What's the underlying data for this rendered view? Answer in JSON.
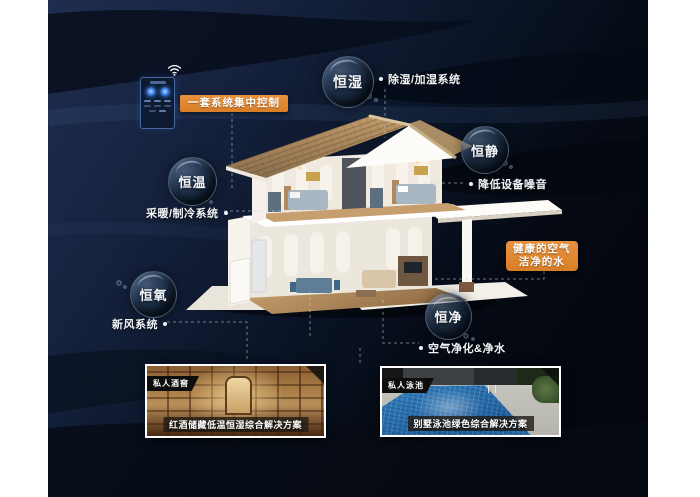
{
  "bubbles": [
    {
      "id": "heng-shi",
      "label": "恒湿"
    },
    {
      "id": "heng-jing",
      "label": "恒静"
    },
    {
      "id": "heng-wen",
      "label": "恒温"
    },
    {
      "id": "heng-yang",
      "label": "恒氧"
    },
    {
      "id": "heng-jing2",
      "label": "恒净"
    }
  ],
  "callouts": [
    {
      "id": "dehumidify",
      "label": "除湿/加湿系统"
    },
    {
      "id": "noise",
      "label": "降低设备噪音"
    },
    {
      "id": "heating",
      "label": "采暖/制冷系统"
    },
    {
      "id": "fresh-air",
      "label": "新风系统"
    },
    {
      "id": "purify",
      "label": "空气净化&净水"
    }
  ],
  "highlights": {
    "control_label": "一套系统集中控制",
    "water_line1": "健康的空气",
    "water_line2": "洁净的水"
  },
  "cards": [
    {
      "tag": "私人酒窖",
      "caption": "红酒储藏低温恒湿综合解决方案"
    },
    {
      "tag": "私人泳池",
      "caption": "别墅泳池绿色综合解决方案"
    }
  ],
  "icons": {
    "wifi": "wifi-icon"
  },
  "colors": {
    "accent_orange": "#dd8630",
    "background_navy": "#15213c",
    "background_black": "#04070e",
    "text_white": "#ffffff",
    "roof_tan": "#b59164"
  }
}
